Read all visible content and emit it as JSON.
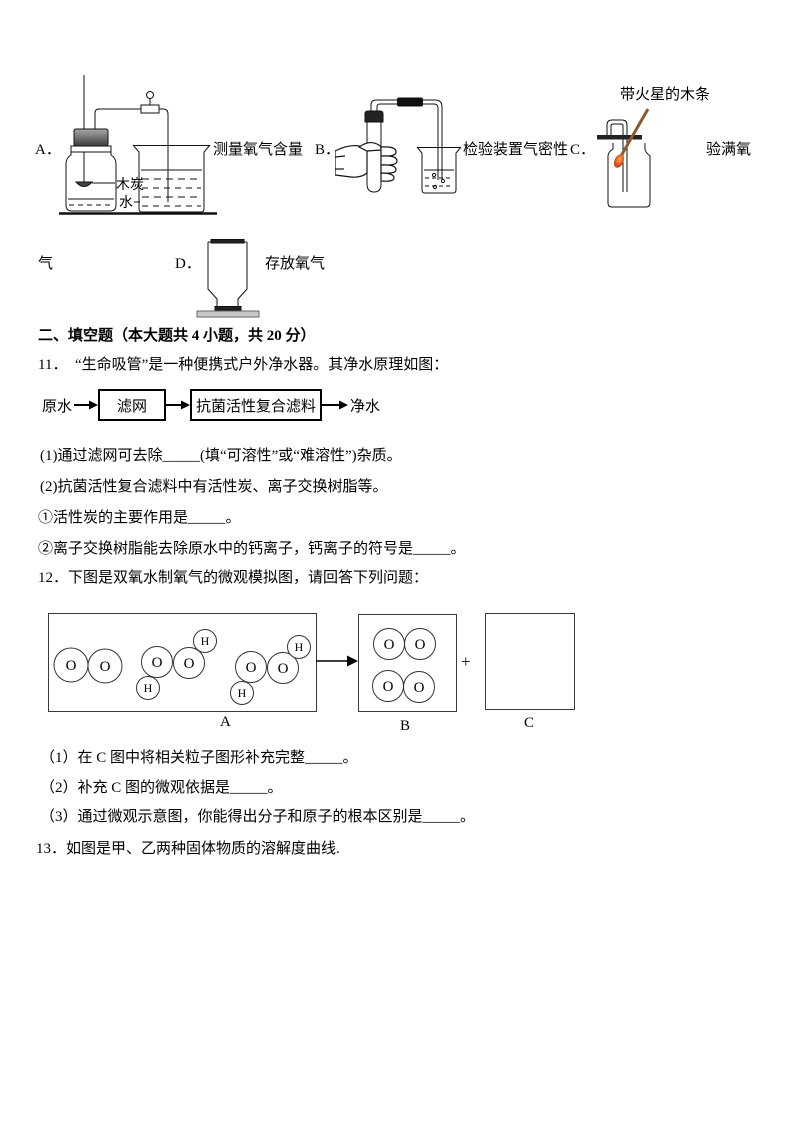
{
  "apparatus": {
    "a_label": "A．",
    "a_caption": "测量氧气含量",
    "a_charcoal": "木炭",
    "a_water": "水",
    "b_label": "B．",
    "b_caption": "检验装置气密性",
    "c_label": "C．",
    "c_splint_label": "带火星的木条",
    "c_caption": "验满氧",
    "c_caption_wrap": "气",
    "d_label": "D．",
    "d_caption": "存放氧气"
  },
  "section_title": "二、填空题（本大题共 4 小题，共 20 分）",
  "q11": {
    "stem": "11．　“生命吸管”是一种便携式户外净水器。其净水原理如图：",
    "flow": {
      "source": "原水",
      "box1": "滤网",
      "box2": "抗菌活性复合滤料",
      "result": "净水"
    },
    "p1": "(1)通过滤网可去除_____(填“可溶性”或“难溶性”)杂质。",
    "p2": "(2)抗菌活性复合滤料中有活性炭、离子交换树脂等。",
    "p2_1": "①活性炭的主要作用是_____。",
    "p2_2": "②离子交换树脂能去除原水中的钙离子，钙离子的符号是_____。"
  },
  "q12": {
    "stem": "12．下图是双氧水制氧气的微观模拟图，请回答下列问题：",
    "atom_o": "O",
    "atom_h": "H",
    "label_a": "A",
    "label_b": "B",
    "label_c": "C",
    "plus": "+",
    "p1": "（1）在 C 图中将相关粒子图形补充完整_____。",
    "p2": "（2）补充 C 图的微观依据是_____。",
    "p3": "（3）通过微观示意图，你能得出分子和原子的根本区别是_____。"
  },
  "q13": {
    "stem": "13．如图是甲、乙两种固体物质的溶解度曲线."
  }
}
